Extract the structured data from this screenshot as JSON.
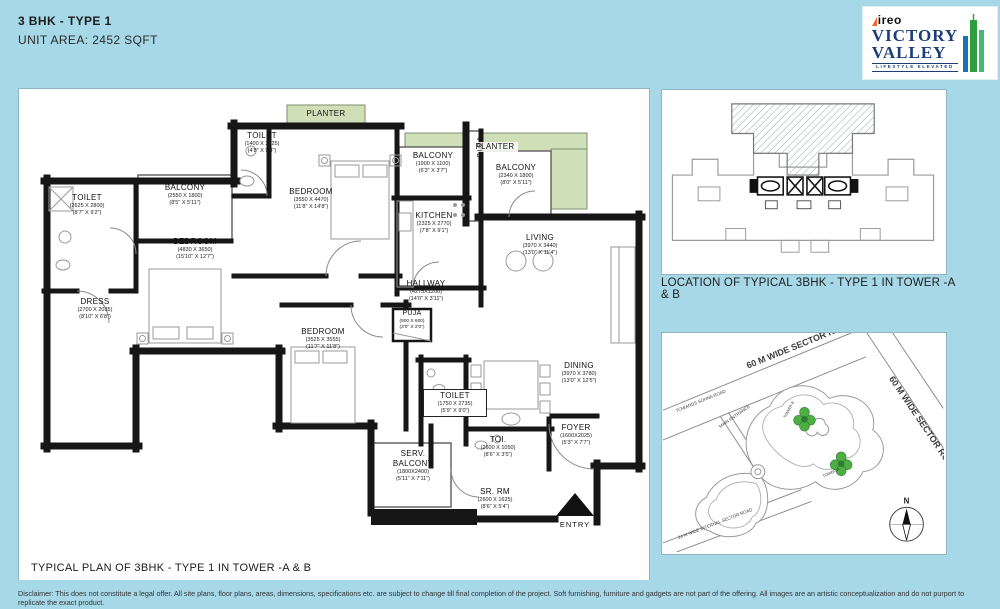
{
  "header": {
    "title": "3 BHK - TYPE 1",
    "subtitle": "UNIT AREA: 2452 SQFT"
  },
  "logo": {
    "brand": "ireo",
    "line1": "VICTORY",
    "line2": "VALLEY",
    "tagline": "LIFESTYLE ELEVATED"
  },
  "plan": {
    "caption": "TYPICAL PLAN OF 3BHK - TYPE 1 IN TOWER -A & B",
    "planter_label": "PLANTER",
    "void_label": "VOID",
    "entry_label": "ENTRY",
    "rooms": [
      {
        "id": "toilet-top",
        "name": "TOILET",
        "mm": "(1400 X 2825)",
        "ft": "(4'8\" X 9'3\")"
      },
      {
        "id": "bedroom-top",
        "name": "BEDROOM",
        "mm": "(3550 X 4470)",
        "ft": "(11'8\" X 14'8\")"
      },
      {
        "id": "balcony-kitchen",
        "name": "BALCONY",
        "mm": "(1900 X 1100)",
        "ft": "(6'3\" X 3'7\")"
      },
      {
        "id": "balcony-living",
        "name": "BALCONY",
        "mm": "(2340 X 1800)",
        "ft": "(8'0\" X 5'11\")"
      },
      {
        "id": "toilet-left",
        "name": "TOILET",
        "mm": "(2625 X 2800)",
        "ft": "(8'7\" X 9'2\")"
      },
      {
        "id": "balcony-left",
        "name": "BALCONY",
        "mm": "(2550 X 1800)",
        "ft": "(8'5\" X 5'11\")"
      },
      {
        "id": "kitchen",
        "name": "KITCHEN",
        "mm": "(2325 X 2770)",
        "ft": "(7'8\" X 9'1\")"
      },
      {
        "id": "living",
        "name": "LIVING",
        "mm": "(3970 X 3440)",
        "ft": "(13'0\" X 11'4\")"
      },
      {
        "id": "bedroom-left",
        "name": "BEDROOM",
        "mm": "(4830 X 3650)",
        "ft": "(15'10\" X 12'7\")"
      },
      {
        "id": "dress",
        "name": "DRESS",
        "mm": "(2700 X 2035)",
        "ft": "(8'10\" X 6'8\")"
      },
      {
        "id": "hallway",
        "name": "HALLWAY",
        "mm": "(4275X1200)",
        "ft": "(14'0\" X 3'11\")"
      },
      {
        "id": "puja",
        "name": "PUJA",
        "mm": "(900 X 600)",
        "ft": "(3'0\" X 2'0\")"
      },
      {
        "id": "bedroom-mid",
        "name": "BEDROOM",
        "mm": "(3525 X 3555)",
        "ft": "(11'7\" X 11'8\")"
      },
      {
        "id": "dining",
        "name": "DINING",
        "mm": "(3970 X 3780)",
        "ft": "(13'0\" X 12'5\")"
      },
      {
        "id": "toilet-mid",
        "name": "TOILET",
        "mm": "(1750 X 2735)",
        "ft": "(5'9\" X 9'0\")"
      },
      {
        "id": "toi",
        "name": "TOI.",
        "mm": "(2600 X 1050)",
        "ft": "(8'6\" X 3'5\")"
      },
      {
        "id": "foyer",
        "name": "FOYER",
        "mm": "(1600X2025)",
        "ft": "(5'3\" X 7'7\")"
      },
      {
        "id": "serv-balcony",
        "name": "SERV.\nBALCONY",
        "mm": "(1800X2400)",
        "ft": "(5'11\" X 7'11\")"
      },
      {
        "id": "sr-rm",
        "name": "SR. RM",
        "mm": "(2600 X 1625)",
        "ft": "(8'6\" X 5'4\")"
      }
    ]
  },
  "location": {
    "caption": "LOCATION OF TYPICAL 3BHK - TYPE 1 IN TOWER -A & B"
  },
  "map": {
    "road_top": "60 M WIDE SECTOR ROAD",
    "road_right": "60 M WIDE SECTOR ROAD",
    "road_bottom": "24 M WIDE INTERNAL SECTOR ROAD",
    "towards": "TOWARDS SOHNA ROAD",
    "entrance": "MAIN ENTRANCE",
    "tower_a": "TOWER A",
    "tower_b": "TOWER B",
    "north": "N"
  },
  "footer": {
    "disclaimer": "Disclaimer: This does not constitute a legal offer. All site plans, floor plans, areas, dimensions, specifications etc. are subject to change till final completion of the project. Soft furnishing, furniture and gadgets are not part of the offering. All images are an artistic conceptualization and do not purport to replicate the exact product."
  },
  "colors": {
    "background": "#a6d8e8",
    "wall": "#161616",
    "planter_green": "#cfe0b8",
    "tower_green": "#4fae43",
    "brand_navy": "#1c3e77",
    "brand_orange": "#f26822"
  }
}
